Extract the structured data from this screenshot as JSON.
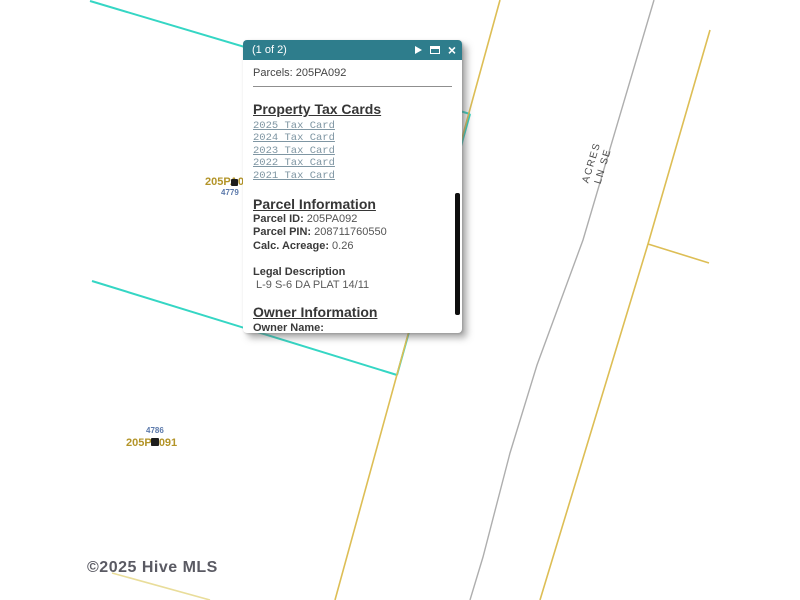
{
  "popup": {
    "paging": "(1 of 2)",
    "close_glyph": "×",
    "title": "Parcels: 205PA092",
    "tax_cards": {
      "heading": "Property Tax Cards",
      "links": [
        "2025 Tax Card",
        "2024 Tax Card",
        "2023 Tax Card",
        "2022 Tax Card",
        "2021 Tax Card"
      ]
    },
    "parcel_info": {
      "heading": "Parcel Information",
      "fields": [
        {
          "label": "Parcel ID:",
          "value": "205PA092"
        },
        {
          "label": "Parcel PIN:",
          "value": "208711760550"
        },
        {
          "label": "Calc. Acreage:",
          "value": "0.26"
        }
      ],
      "legal_label": "Legal Description",
      "legal_value": "L-9 S-6 DA PLAT 14/11"
    },
    "owner_info": {
      "heading": "Owner Information",
      "owner_label": "Owner Name:",
      "zoom_to": "Zoom to",
      "ellipsis": "•••"
    }
  },
  "map": {
    "labels": {
      "parcel_1": "205PA092",
      "parcel_1_address": "4779",
      "parcel_2": "205PA091",
      "parcel_2_address": "4786",
      "road_line1": "ACRES",
      "road_line2": "LN SE"
    },
    "watermark": "©2025 Hive MLS",
    "colors": {
      "popup_header": "#2e7d8c",
      "parcel_boundary_cyan": "#35d6c4",
      "parcel_line_yellow": "#ddbe55",
      "parcel_line_faint_yellow": "#e9dd9a",
      "road_gray": "#aeaeae",
      "parcel_label_olive": "#b39428",
      "address_blue": "#5b79ab"
    }
  }
}
